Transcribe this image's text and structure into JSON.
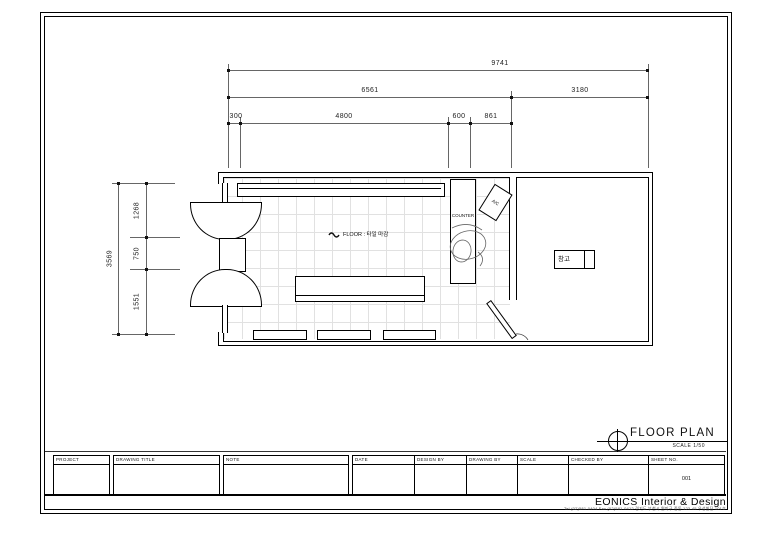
{
  "drawing": {
    "title": "FLOOR PLAN",
    "scale_label": "SCALE  1/50",
    "sheet_no": "001",
    "company": "EONICS Interior & Design",
    "contact": "Tel.(02)581-0404  Fax.(02)581-0412   경기도 부천시 원미구 중동 123-45 우성빌딩 101호"
  },
  "plan_labels": {
    "counter": "COUNTER",
    "ac": "A/C",
    "storage": "창고",
    "floor_finish": "FLOOR : 타일 마감"
  },
  "dimensions": {
    "horizontal": {
      "overall": "9741",
      "left_span": "6561",
      "right_span": "3180",
      "segments": [
        "300",
        "4800",
        "600",
        "861"
      ]
    },
    "vertical": {
      "overall": "3569",
      "segments": [
        "1268",
        "750",
        "1551"
      ]
    }
  },
  "title_block": {
    "fields": [
      {
        "label": "PROJECT",
        "value": ""
      },
      {
        "label": "DRAWING TITLE",
        "value": ""
      },
      {
        "label": "NOTE",
        "value": ""
      },
      {
        "label": "DATE",
        "value": ""
      },
      {
        "label": "DESIGN BY",
        "value": ""
      },
      {
        "label": "DRAWING BY",
        "value": ""
      },
      {
        "label": "SCALE",
        "value": ""
      },
      {
        "label": "CHECKED BY",
        "value": ""
      },
      {
        "label": "SHEET NO.",
        "value": "001"
      }
    ]
  }
}
